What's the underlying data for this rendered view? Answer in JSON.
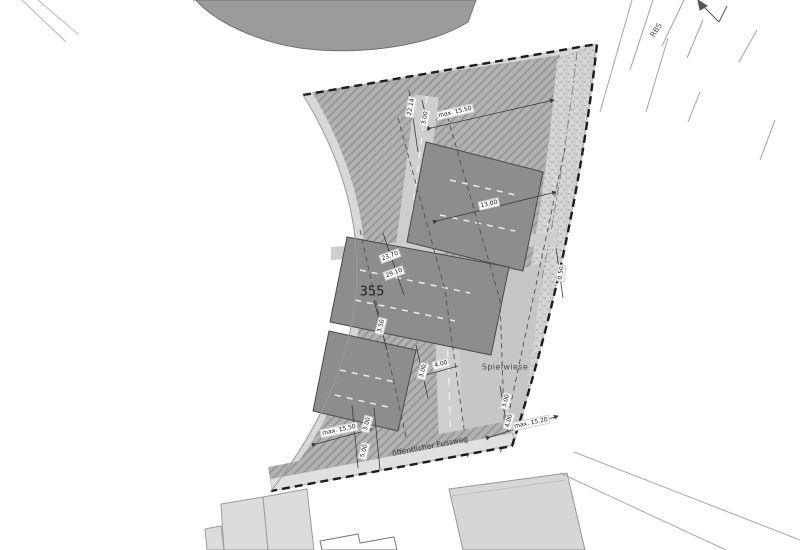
{
  "plan": {
    "parcel_number": "355",
    "area_labels": {
      "railway": "RBS",
      "playfield": "Spielwiese",
      "footpath": "öffentlicher Fussweg"
    },
    "dims": [
      {
        "id": "top-max-height",
        "text": "max. 15.50"
      },
      {
        "id": "top-depth",
        "text": "22.14"
      },
      {
        "id": "top-setback",
        "text": "3.00"
      },
      {
        "id": "center-width",
        "text": "13.00"
      },
      {
        "id": "left-length-a",
        "text": "23.70"
      },
      {
        "id": "left-length-b",
        "text": "29.10"
      },
      {
        "id": "left-setback",
        "text": "3.50"
      },
      {
        "id": "right-strip",
        "text": "0.50"
      },
      {
        "id": "mid-path-a",
        "text": "3.00"
      },
      {
        "id": "mid-path-b",
        "text": "4.00"
      },
      {
        "id": "bottom-left-max-height",
        "text": "max. 15.50"
      },
      {
        "id": "bottom-left-a",
        "text": "3.00"
      },
      {
        "id": "bottom-left-b",
        "text": "5.00"
      },
      {
        "id": "bottom-right-a",
        "text": "3.00"
      },
      {
        "id": "bottom-right-b",
        "text": "4.00"
      },
      {
        "id": "bottom-right-max-height",
        "text": "max. 15.20"
      }
    ]
  },
  "colors": {
    "neighbor_building": "#9b9b9b",
    "parcel_base": "#d8d8d8",
    "building_dark": "#8d8d8d",
    "playfield": "#c6c6c6",
    "road": "#cecece",
    "footpath": "#e0e0e0",
    "boundary": "#1c1c1c",
    "hatch_base": "#b2b2b2"
  }
}
